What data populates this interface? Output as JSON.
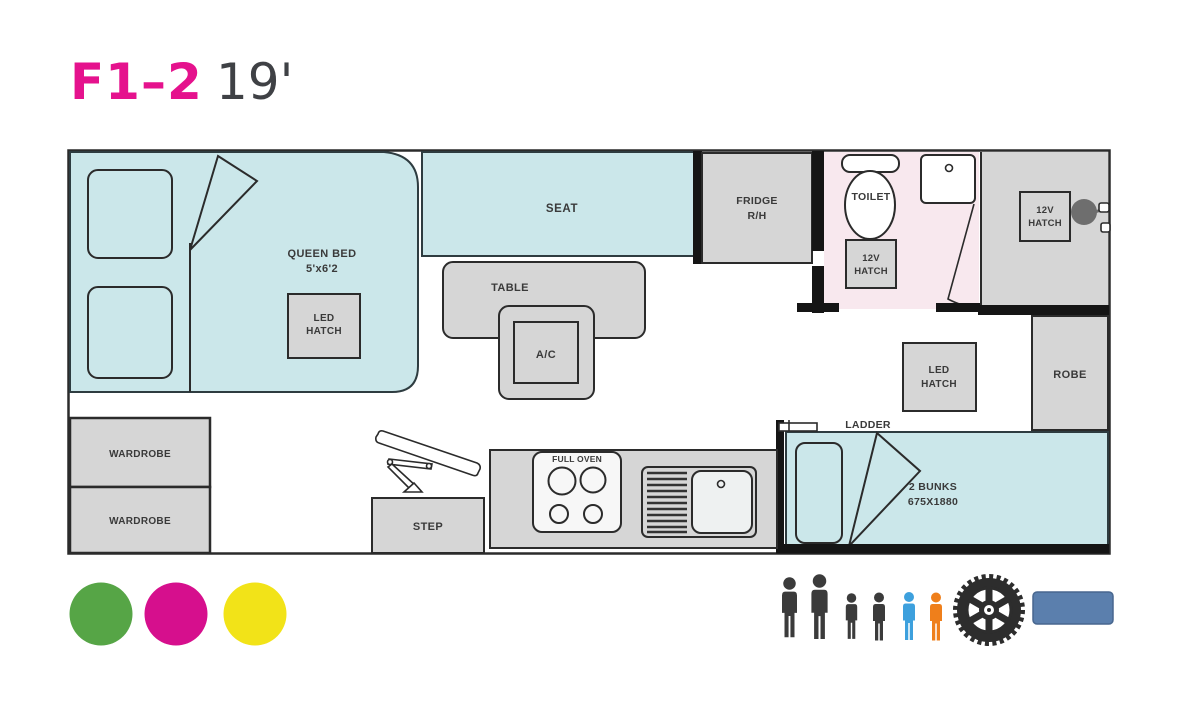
{
  "title": {
    "model": "F1–2",
    "length": "19'"
  },
  "colors": {
    "title_model": "#e5128d",
    "title_length": "#3f4145",
    "area_cyan": "#cbe7ea",
    "area_pink": "#f8e8ee",
    "area_gray": "#d6d6d6",
    "wall": "#151515",
    "outline": "#2b2b2b",
    "label_text": "#3a3a3a",
    "fixture_gray": "#6e6e6e",
    "legend_green": "#56a546",
    "legend_magenta": "#d60f8d",
    "legend_yellow": "#f2e318",
    "person_dark": "#3b3b3b",
    "person_blue": "#3da0dd",
    "person_orange": "#ef7f1b",
    "tire": "#2d2d2d",
    "bar_blue": "#5b7fad",
    "bar_blue_border": "#48678f"
  },
  "floorplan": {
    "bed": {
      "name": "QUEEN BED",
      "size": "5'x6'2",
      "hatch1": "LED",
      "hatch2": "HATCH"
    },
    "seat": "SEAT",
    "table": "TABLE",
    "ac": "A/C",
    "fridge1": "FRIDGE",
    "fridge2": "R/H",
    "bathroom": {
      "toilet": "TOILET",
      "hatch1": "12V",
      "hatch2": "HATCH"
    },
    "shower": {
      "hatch1": "12V",
      "hatch2": "HATCH"
    },
    "rear": {
      "hatch1": "LED",
      "hatch2": "HATCH",
      "robe": "ROBE",
      "ladder": "LADDER",
      "bunks1": "2 BUNKS",
      "bunks2": "675X1880"
    },
    "kitchen": {
      "oven": "FULL OVEN",
      "step": "STEP"
    },
    "wardrobe1": "WARDROBE",
    "wardrobe2": "WARDROBE"
  },
  "legend": {
    "swatches": [
      {
        "name": "green-dot",
        "color": "#56a546"
      },
      {
        "name": "magenta-dot",
        "color": "#d60f8d"
      },
      {
        "name": "yellow-dot",
        "color": "#f2e318"
      }
    ],
    "occupants": [
      {
        "type": "adult",
        "color": "#3b3b3b"
      },
      {
        "type": "adult",
        "color": "#3b3b3b"
      },
      {
        "type": "child",
        "color": "#3b3b3b"
      },
      {
        "type": "child",
        "color": "#3b3b3b"
      },
      {
        "type": "child",
        "color": "#3da0dd"
      },
      {
        "type": "child",
        "color": "#ef7f1b"
      }
    ],
    "tire_icon": "tire-icon",
    "feature_bar_icon": "feature-bar"
  }
}
